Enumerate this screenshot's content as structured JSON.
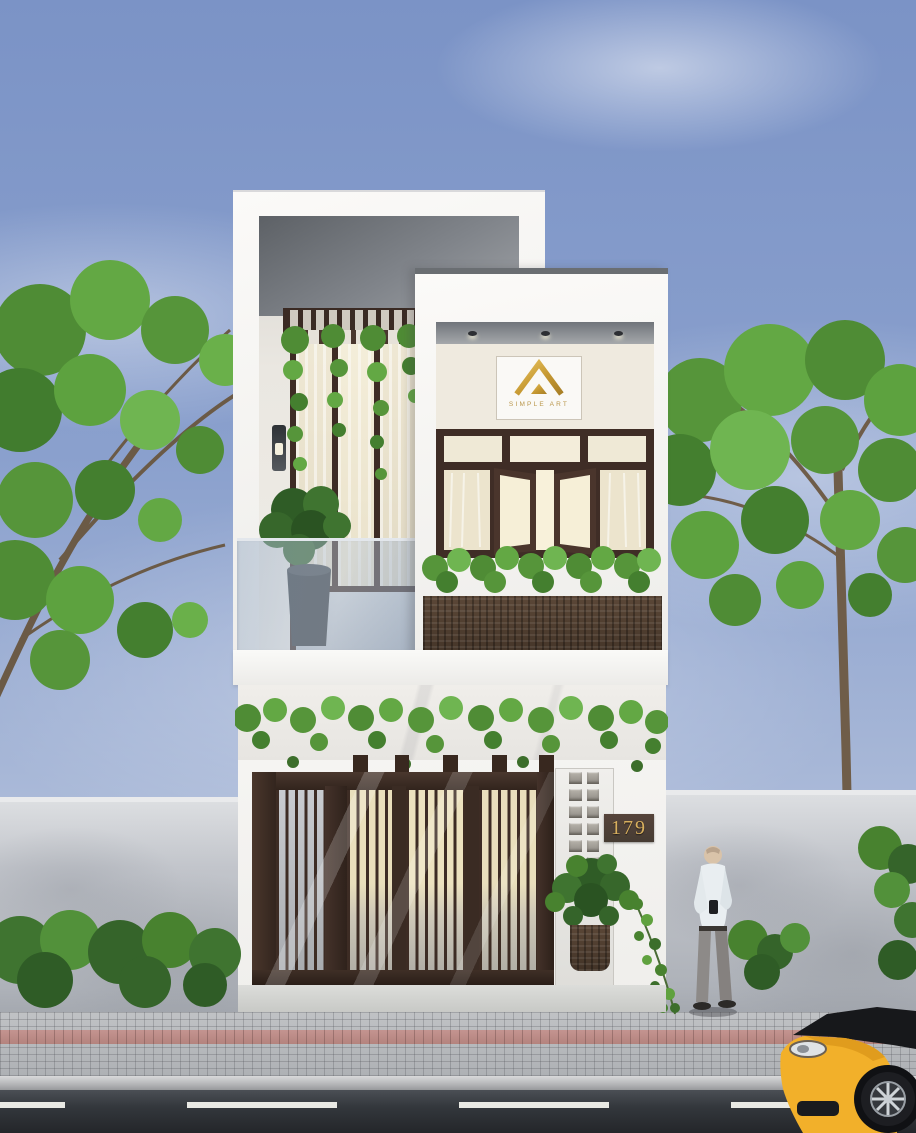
{
  "scene": {
    "type": "architectural-exterior-rendering",
    "description": "Modern two-storey white townhouse with dark timber slatted gate and windows, hanging greenery, street trees, concrete fences, paved sidewalk, asphalt road, yellow sports car and a man looking at his phone",
    "branding": {
      "name": "SIMPLE ART",
      "monogram": "A"
    },
    "house": {
      "number": "179",
      "storeys": "2"
    },
    "palette": {
      "sky_top": "#7b93c6",
      "sky_horizon": "#c5cfe2",
      "facade_white": "#f5f4f1",
      "soffit_gray": "#71757b",
      "timber_dark": "#412f28",
      "glass_warm": "#f2e9cf",
      "foliage_green": "#5c9a3f",
      "foliage_dark": "#3c6e2b",
      "fence_concrete": "#c7cad0",
      "paver_gray": "#b4b7bb",
      "paver_accent_pink": "#bb8b85",
      "asphalt": "#2f3337",
      "lane_marking": "#e9e9e4",
      "car_yellow": "#f2b02a",
      "gold": "#caa145",
      "plaque_brown": "#4d453b"
    }
  }
}
